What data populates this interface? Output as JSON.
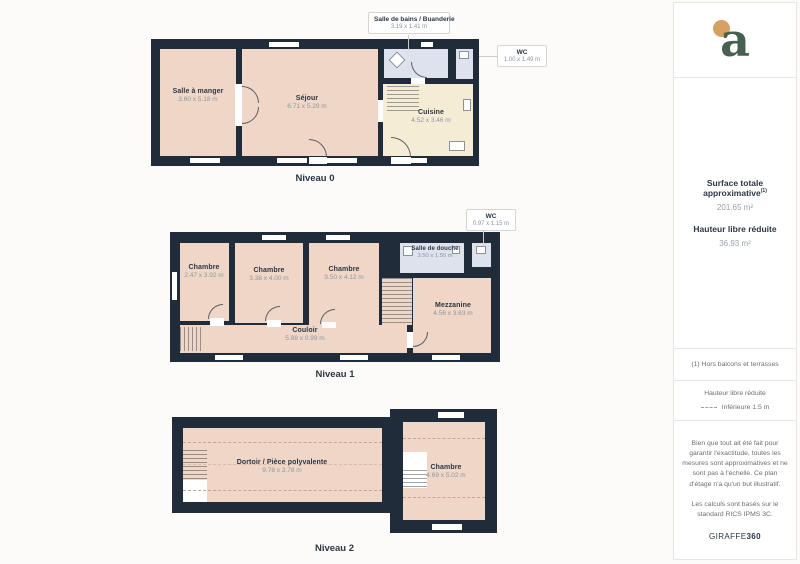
{
  "colors": {
    "wall": "#212c3a",
    "room": "#efd6c7",
    "wet": "#dde2ed",
    "kitchen": "#f5ecd6",
    "logo_green": "#47604f",
    "logo_dot": "#d8a063",
    "ink": "#2b3645"
  },
  "branding": {
    "logo_letter": "a"
  },
  "floors": [
    {
      "caption": "Niveau 0",
      "callouts": [
        {
          "title": "Salle de bains / Buanderie",
          "dims": "3.19 x 1.41 m"
        },
        {
          "title": "WC",
          "dims": "1.00 x 1.49 m"
        }
      ],
      "rooms": [
        {
          "name": "Salle à manger",
          "dims": "3.60 x 5.18 m"
        },
        {
          "name": "Séjour",
          "dims": "6.71 x 5.29 m"
        },
        {
          "name": "Cuisine",
          "dims": "4.52 x 3.46 m"
        }
      ]
    },
    {
      "caption": "Niveau 1",
      "callouts": [
        {
          "title": "WC",
          "dims": "0.97 x 1.15 m"
        }
      ],
      "rooms": [
        {
          "name": "Chambre",
          "dims": "2.47 x 3.92 m"
        },
        {
          "name": "Chambre",
          "dims": "3.38 x 4.00 m"
        },
        {
          "name": "Chambre",
          "dims": "3.50 x 4.12 m"
        },
        {
          "name": "Salle de douche",
          "dims": "3.50 x 1.50 m"
        },
        {
          "name": "Mezzanine",
          "dims": "4.56 x 3.63 m"
        },
        {
          "name": "Couloir",
          "dims": "5.88 x 0.99 m"
        }
      ]
    },
    {
      "caption": "Niveau 2",
      "rooms": [
        {
          "name": "Dortoir / Pièce polyvalente",
          "dims": "9.78 x 3.78 m"
        },
        {
          "name": "Chambre",
          "dims": "4.69 x 5.02 m"
        }
      ]
    }
  ],
  "sidebar": {
    "surface_title": "Surface totale approximative",
    "surface_footnote_marker": "(1)",
    "surface_value": "201.65 m²",
    "reduced_title": "Hauteur libre réduite",
    "reduced_value": "36.93 m²",
    "footnote": "(1) Hors balcons et terrasses",
    "legend_title": "Hauteur libre réduite",
    "legend_label": "Inférieure 1.5 m",
    "disclaimer": "Bien que tout ait été fait pour garantir l'exactitude, toutes les mesures sont approximatives et ne sont pas à l'échelle. Ce plan d'étage n'a qu'un but illustratif.",
    "standard": "Les calculs sont basés sur le standard RICS IPMS 3C.",
    "brand": "GIRAFFE",
    "brand_bold": "360"
  }
}
